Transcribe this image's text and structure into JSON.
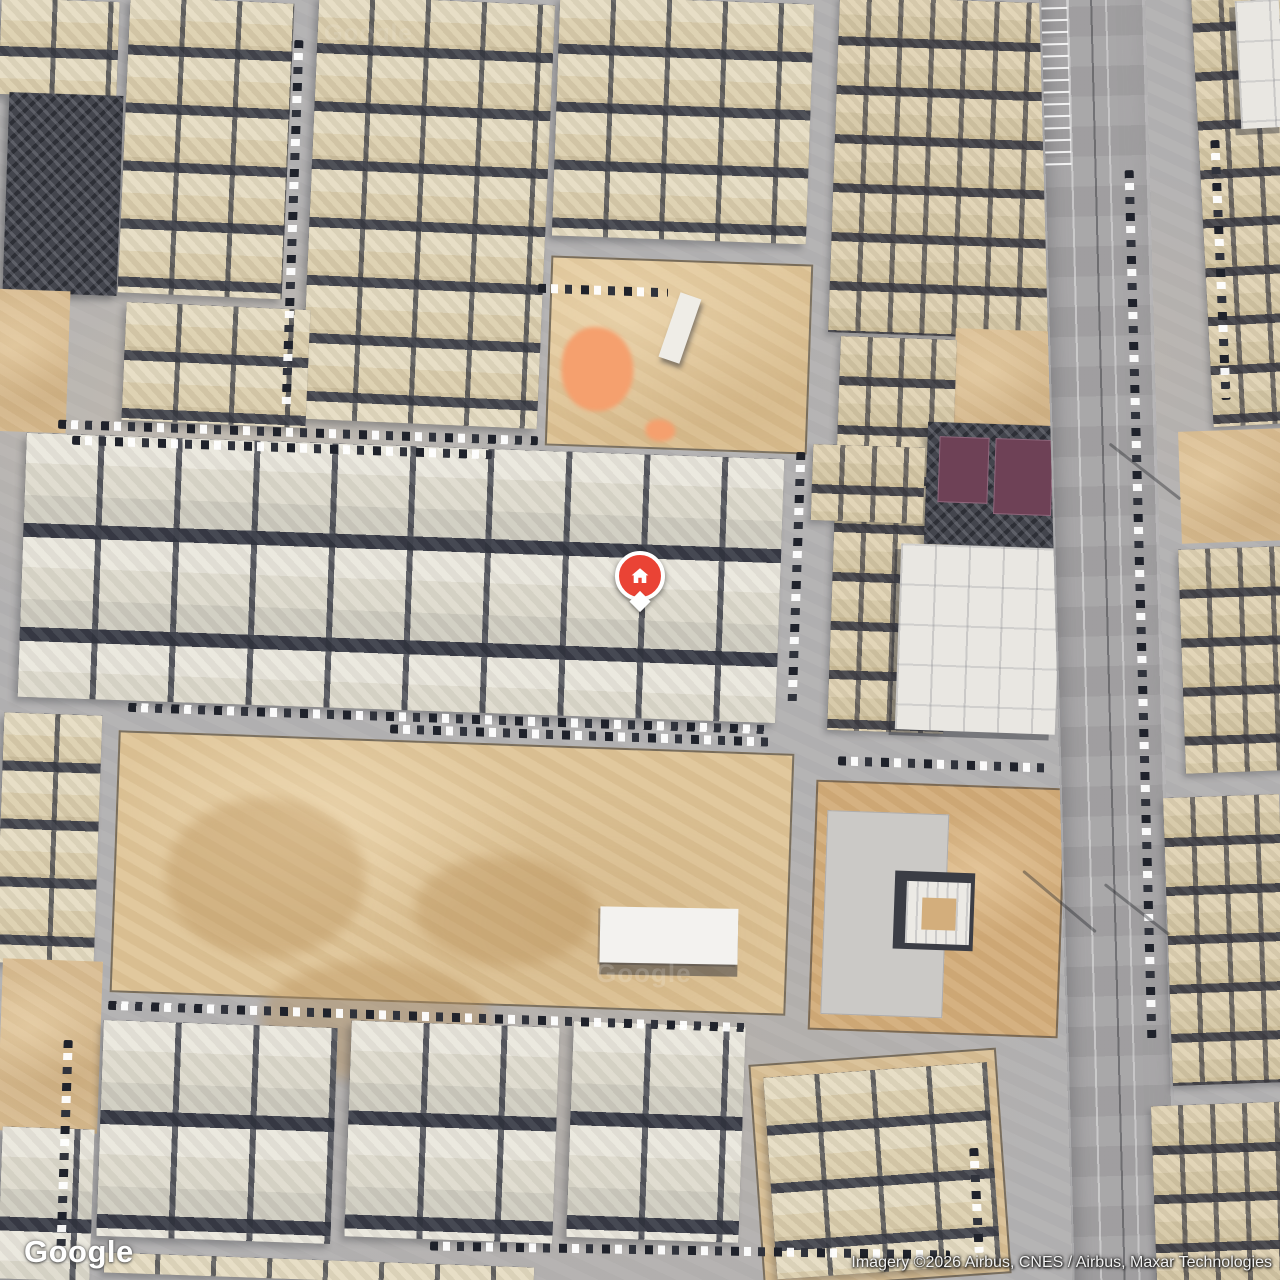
{
  "meta": {
    "app": "satellite-map-view",
    "width": 1280,
    "height": 1280
  },
  "branding": {
    "logo_text": "Google"
  },
  "attribution": {
    "text": "Imagery ©2026 Airbus, CNES / Airbus, Maxar Technologies"
  },
  "marker": {
    "kind": "home-place-pin",
    "x": 640,
    "y": 577,
    "pin_color": "#EA4335",
    "ring_color": "#FFFFFF",
    "icon": "home-icon"
  },
  "watermarks": [
    {
      "text": "Google",
      "x": 596,
      "y": 958,
      "size": 26,
      "opacity": 0.16
    },
    {
      "text": "Google",
      "x": 324,
      "y": 20,
      "size": 24,
      "opacity": 0.1
    }
  ],
  "palette": {
    "road_gray": "#b4b2b3",
    "roof_white": "#eae7dd",
    "roof_cream": "#e6dcc2",
    "roof_tan": "#e0d3b4",
    "shadow_dark": "#383b46",
    "sand": "#d9bd92",
    "sand_bright": "#dfc598",
    "orange_patch": "#f5a06e",
    "court_purple": "#6e4156",
    "asphalt": "#a6a4a6"
  },
  "map_regions": [
    {
      "name": "tl-villas-a",
      "cls": "villas-cream",
      "x": 0,
      "y": 0,
      "w": 118,
      "h": 96,
      "rot": 2
    },
    {
      "name": "rubble-block",
      "cls": "dark-block",
      "x": 6,
      "y": 94,
      "w": 114,
      "h": 200,
      "rot": 2
    },
    {
      "name": "left-sand-a",
      "cls": "sand-plain",
      "x": -8,
      "y": 290,
      "w": 76,
      "h": 142,
      "rot": 2
    },
    {
      "name": "tl-villas-b",
      "cls": "villas-cream",
      "x": 124,
      "y": 0,
      "w": 164,
      "h": 296,
      "rot": 2.5
    },
    {
      "name": "tl-villas-c",
      "cls": "villas-cream",
      "x": 310,
      "y": 0,
      "w": 236,
      "h": 424,
      "rot": 2.5
    },
    {
      "name": "tl-villas-d",
      "cls": "villas-cream",
      "x": 124,
      "y": 306,
      "w": 184,
      "h": 118,
      "rot": 2.5
    },
    {
      "name": "tm-villas",
      "cls": "villas-cream",
      "x": 556,
      "y": 0,
      "w": 254,
      "h": 240,
      "rot": 2
    },
    {
      "name": "tm-sand-lot",
      "cls": "sand-lot",
      "x": 548,
      "y": 260,
      "w": 262,
      "h": 190,
      "rot": 2,
      "children": [
        {
          "name": "orange-patch",
          "cls": "orange-blob",
          "x": 12,
          "y": 68,
          "w": 72,
          "h": 84
        },
        {
          "name": "orange-patch-small",
          "cls": "orange-blob",
          "x": 98,
          "y": 158,
          "w": 30,
          "h": 22
        },
        {
          "name": "site-shed",
          "cls": "shed",
          "x": 118,
          "y": 32,
          "w": 22,
          "h": 68,
          "rot": 17
        }
      ]
    },
    {
      "name": "tr-villas-a",
      "cls": "villas-tan",
      "x": 834,
      "y": 0,
      "w": 226,
      "h": 336,
      "rot": 2
    },
    {
      "name": "tr-sand",
      "cls": "sand-plain",
      "x": 954,
      "y": 330,
      "w": 106,
      "h": 106,
      "rot": 2
    },
    {
      "name": "tr-villas-b",
      "cls": "villas-tan",
      "x": 834,
      "y": 338,
      "w": 116,
      "h": 394,
      "rot": 2
    },
    {
      "name": "courts-building",
      "cls": "dark-block",
      "x": 926,
      "y": 424,
      "w": 134,
      "h": 122,
      "rot": 2,
      "children": [
        {
          "name": "sports-court-a",
          "cls": "purple-court",
          "x": 12,
          "y": 14,
          "w": 50,
          "h": 66
        },
        {
          "name": "sports-court-b",
          "cls": "purple-court",
          "x": 68,
          "y": 14,
          "w": 58,
          "h": 76
        }
      ]
    },
    {
      "name": "white-compound",
      "cls": "white-compound",
      "x": 898,
      "y": 546,
      "w": 160,
      "h": 186,
      "rot": 2
    },
    {
      "name": "mid-villas",
      "cls": "villas-white",
      "x": 22,
      "y": 446,
      "w": 758,
      "h": 264,
      "rot": 2
    },
    {
      "name": "mid-villas-east",
      "cls": "villas-tan",
      "x": 812,
      "y": 446,
      "w": 112,
      "h": 76,
      "rot": 2
    },
    {
      "name": "construction-lot",
      "cls": "sand-lot",
      "x": 114,
      "y": 742,
      "w": 676,
      "h": 262,
      "rot": 2,
      "children": [
        {
          "name": "dirt-mound",
          "cls": "mound",
          "x": 50,
          "y": 60,
          "w": 200,
          "h": 160
        },
        {
          "name": "dirt-mound",
          "cls": "mound",
          "x": 150,
          "y": 220,
          "w": 230,
          "h": 120
        },
        {
          "name": "dirt-mound",
          "cls": "mound",
          "x": 300,
          "y": 110,
          "w": 180,
          "h": 110
        },
        {
          "name": "warehouse",
          "cls": "warehouse",
          "x": 486,
          "y": 156,
          "w": 138,
          "h": 56,
          "rot": -1
        }
      ]
    },
    {
      "name": "left-villas-mid",
      "cls": "villas-cream",
      "x": 0,
      "y": 714,
      "w": 98,
      "h": 250,
      "rot": 2
    },
    {
      "name": "left-sand-b",
      "cls": "sand-plain",
      "x": 0,
      "y": 960,
      "w": 100,
      "h": 172,
      "rot": 2
    },
    {
      "name": "school-compound",
      "cls": "school-lot",
      "x": 812,
      "y": 784,
      "w": 250,
      "h": 250,
      "rot": 2,
      "children": [
        {
          "name": "paved-yard",
          "cls": "pavement",
          "x": 10,
          "y": 28,
          "w": 122,
          "h": 204
        },
        {
          "name": "school-building-shadow",
          "cls": "bldg-shadow",
          "x": 80,
          "y": 86,
          "w": 80,
          "h": 78
        },
        {
          "name": "school-building",
          "cls": "bldg-white",
          "x": 92,
          "y": 96,
          "w": 64,
          "h": 62
        },
        {
          "name": "school-courtyard",
          "cls": "bldg-court",
          "x": 108,
          "y": 112,
          "w": 34,
          "h": 32
        }
      ]
    },
    {
      "name": "bottom-villas-a",
      "cls": "villas-white",
      "x": 100,
      "y": 1024,
      "w": 234,
      "h": 216,
      "rot": 2
    },
    {
      "name": "bottom-villas-b",
      "cls": "villas-white",
      "x": 348,
      "y": 1024,
      "w": 208,
      "h": 216,
      "rot": 2
    },
    {
      "name": "bottom-villas-c",
      "cls": "villas-white",
      "x": 570,
      "y": 1024,
      "w": 172,
      "h": 216,
      "rot": 2
    },
    {
      "name": "bottom-villas-d",
      "cls": "villas-white",
      "x": 0,
      "y": 1128,
      "w": 92,
      "h": 152,
      "rot": 2
    },
    {
      "name": "bottom-villas-sliver",
      "cls": "villas-cream",
      "x": 104,
      "y": 1260,
      "w": 430,
      "h": 20,
      "rot": 2
    },
    {
      "name": "walled-villas",
      "cls": "walled-villas",
      "x": 756,
      "y": 1056,
      "w": 248,
      "h": 226,
      "rot": -4,
      "children": [
        {
          "name": "walled-villas-inner",
          "cls": "villas-cream",
          "x": 12,
          "y": 12,
          "w": 224,
          "h": 202
        }
      ]
    },
    {
      "name": "highway",
      "cls": "highway",
      "x": 1056,
      "y": -24,
      "w": 106,
      "h": 1330,
      "rot": -1.5,
      "children": [
        {
          "name": "parking-bays",
          "cls": "parking-comb",
          "x": 2,
          "y": 18,
          "w": 26,
          "h": 170
        }
      ]
    },
    {
      "name": "r-villas-a",
      "cls": "villas-tan",
      "x": 1202,
      "y": -20,
      "w": 130,
      "h": 444,
      "rot": -3
    },
    {
      "name": "r-white-building",
      "cls": "white-compound",
      "x": 1238,
      "y": 0,
      "w": 44,
      "h": 128,
      "rot": -3
    },
    {
      "name": "r-sand",
      "cls": "sand-plain",
      "x": 1180,
      "y": 430,
      "w": 104,
      "h": 112,
      "rot": -2
    },
    {
      "name": "r-villas-b",
      "cls": "villas-tan",
      "x": 1182,
      "y": 548,
      "w": 102,
      "h": 224,
      "rot": -2
    },
    {
      "name": "r-villas-c",
      "cls": "villas-tan",
      "x": 1168,
      "y": 796,
      "w": 116,
      "h": 288,
      "rot": -2
    },
    {
      "name": "r-villas-d",
      "cls": "villas-tan",
      "x": 1154,
      "y": 1104,
      "w": 130,
      "h": 178,
      "rot": -2
    },
    {
      "name": "parked-cars",
      "cls": "car-strip-h",
      "x": 58,
      "y": 428,
      "w": 480,
      "h": 9,
      "rot": 2
    },
    {
      "name": "parked-cars",
      "cls": "car-strip-h",
      "x": 72,
      "y": 443,
      "w": 420,
      "h": 9,
      "rot": 2
    },
    {
      "name": "parked-cars",
      "cls": "car-strip-h",
      "x": 128,
      "y": 714,
      "w": 640,
      "h": 9,
      "rot": 2
    },
    {
      "name": "parked-cars",
      "cls": "car-strip-h",
      "x": 390,
      "y": 731,
      "w": 380,
      "h": 9,
      "rot": 2
    },
    {
      "name": "parked-cars",
      "cls": "car-strip-h",
      "x": 108,
      "y": 1012,
      "w": 640,
      "h": 9,
      "rot": 2
    },
    {
      "name": "parked-cars",
      "cls": "car-strip-h",
      "x": 430,
      "y": 1246,
      "w": 520,
      "h": 9,
      "rot": 1
    },
    {
      "name": "parked-cars",
      "cls": "car-strip-v",
      "x": 60,
      "y": 1040,
      "w": 9,
      "h": 215,
      "rot": 2
    },
    {
      "name": "parked-cars",
      "cls": "car-strip-v",
      "x": 792,
      "y": 452,
      "w": 9,
      "h": 252,
      "rot": 2
    },
    {
      "name": "parked-cars",
      "cls": "car-strip-v",
      "x": 1136,
      "y": 170,
      "w": 9,
      "h": 870,
      "rot": -1.5
    },
    {
      "name": "parked-cars",
      "cls": "car-strip-h",
      "x": 838,
      "y": 760,
      "w": 215,
      "h": 9,
      "rot": 2
    },
    {
      "name": "parked-cars",
      "cls": "car-strip-v",
      "x": 288,
      "y": 40,
      "w": 9,
      "h": 370,
      "rot": 2
    },
    {
      "name": "parked-cars",
      "cls": "car-strip-h",
      "x": 538,
      "y": 286,
      "w": 130,
      "h": 9,
      "rot": 2
    },
    {
      "name": "parked-cars",
      "cls": "car-strip-v",
      "x": 972,
      "y": 1148,
      "w": 9,
      "h": 105,
      "rot": -3
    },
    {
      "name": "parked-cars",
      "cls": "car-strip-v",
      "x": 1216,
      "y": 140,
      "w": 9,
      "h": 260,
      "rot": -2.5
    },
    {
      "name": "pole-shadow",
      "cls": "shadow-line",
      "x": 1100,
      "y": 470,
      "w": 90,
      "h": 3,
      "rot": 38
    },
    {
      "name": "pole-shadow",
      "cls": "shadow-line",
      "x": 1012,
      "y": 900,
      "w": 95,
      "h": 3,
      "rot": 40
    },
    {
      "name": "pole-shadow",
      "cls": "shadow-line",
      "x": 1096,
      "y": 908,
      "w": 82,
      "h": 3,
      "rot": 38
    }
  ]
}
